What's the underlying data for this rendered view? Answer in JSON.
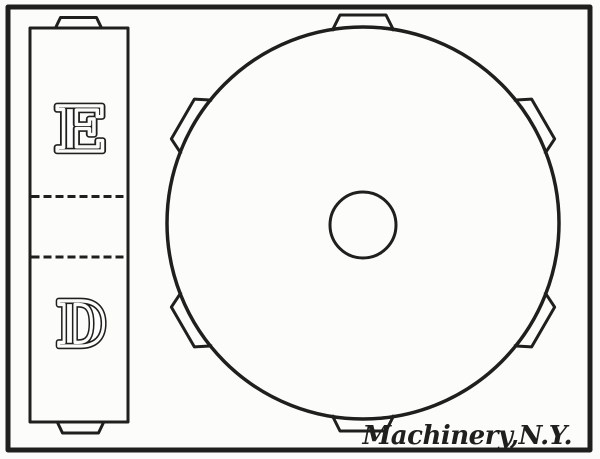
{
  "colors": {
    "ink": "#1f1f1d",
    "paper": "#fcfcfa"
  },
  "left_view": {
    "label_top": "E",
    "label_bottom": "D",
    "section_line_count": 2,
    "key_tab_count": 2
  },
  "disc_view": {
    "lug_count": 6,
    "has_center_bore": true
  },
  "credit": "Machinery,N.Y."
}
